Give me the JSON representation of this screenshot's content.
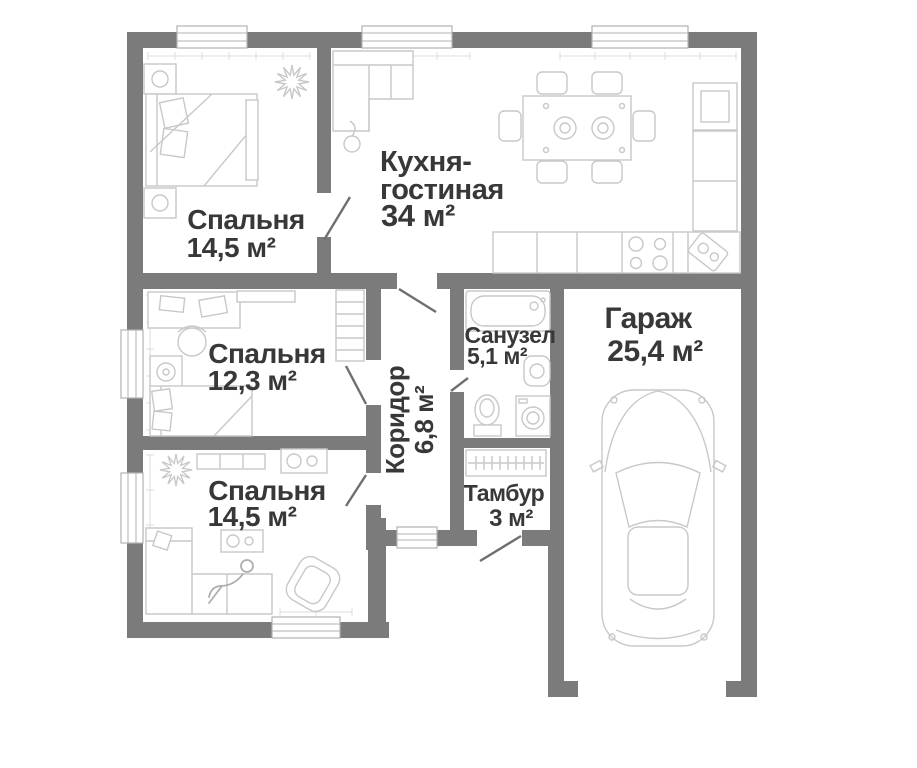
{
  "app": {
    "type": "apartment-floor-plan"
  },
  "colors": {
    "wall": "#7b7b7b",
    "label": "#383838",
    "furniture": "#c8c8c8",
    "furniture-dark": "#aeaeae",
    "window-line": "#b2b2b2",
    "ruler": "#dcdcdc",
    "door": "#6f6f6f",
    "floor": "#ffffff"
  },
  "rooms": {
    "bedroom1": {
      "label": "Спальня",
      "area": "14,5 м²"
    },
    "kitchen_living": {
      "label_line1": "Кухня-",
      "label_line2": "гостиная",
      "area": "34 м²"
    },
    "bedroom2": {
      "label": "Спальня",
      "area": "12,3 м²"
    },
    "corridor": {
      "label": "Коридор",
      "area": "6,8 м²"
    },
    "bathroom": {
      "label": "Санузел",
      "area": "5,1 м²"
    },
    "garage": {
      "label": "Гараж",
      "area": "25,4 м²"
    },
    "vestibule": {
      "label": "Тамбур",
      "area": "3 м²"
    },
    "bedroom3": {
      "label": "Спальня",
      "area": "14,5 м²"
    }
  },
  "furniture": {
    "bedroom1": [
      "nightstand",
      "double-bed",
      "bench",
      "nightstand",
      "plant"
    ],
    "kitchen_living": [
      "corner-sofa",
      "floor-lamp",
      "dining-table",
      "six-chairs",
      "fridge",
      "tall-cabinet",
      "kitchen-counter",
      "stove",
      "sink"
    ],
    "bedroom2": [
      "desk",
      "desk-chair",
      "speaker",
      "bed",
      "tv-shelf",
      "wardrobe"
    ],
    "bathroom": [
      "bathtub",
      "washbasin",
      "toilet",
      "washing-machine"
    ],
    "vestibule": [
      "closet"
    ],
    "garage": [
      "car"
    ],
    "bedroom3": [
      "plant",
      "tv-console",
      "dresser",
      "corner-sofa",
      "coffee-table",
      "armchair"
    ]
  }
}
